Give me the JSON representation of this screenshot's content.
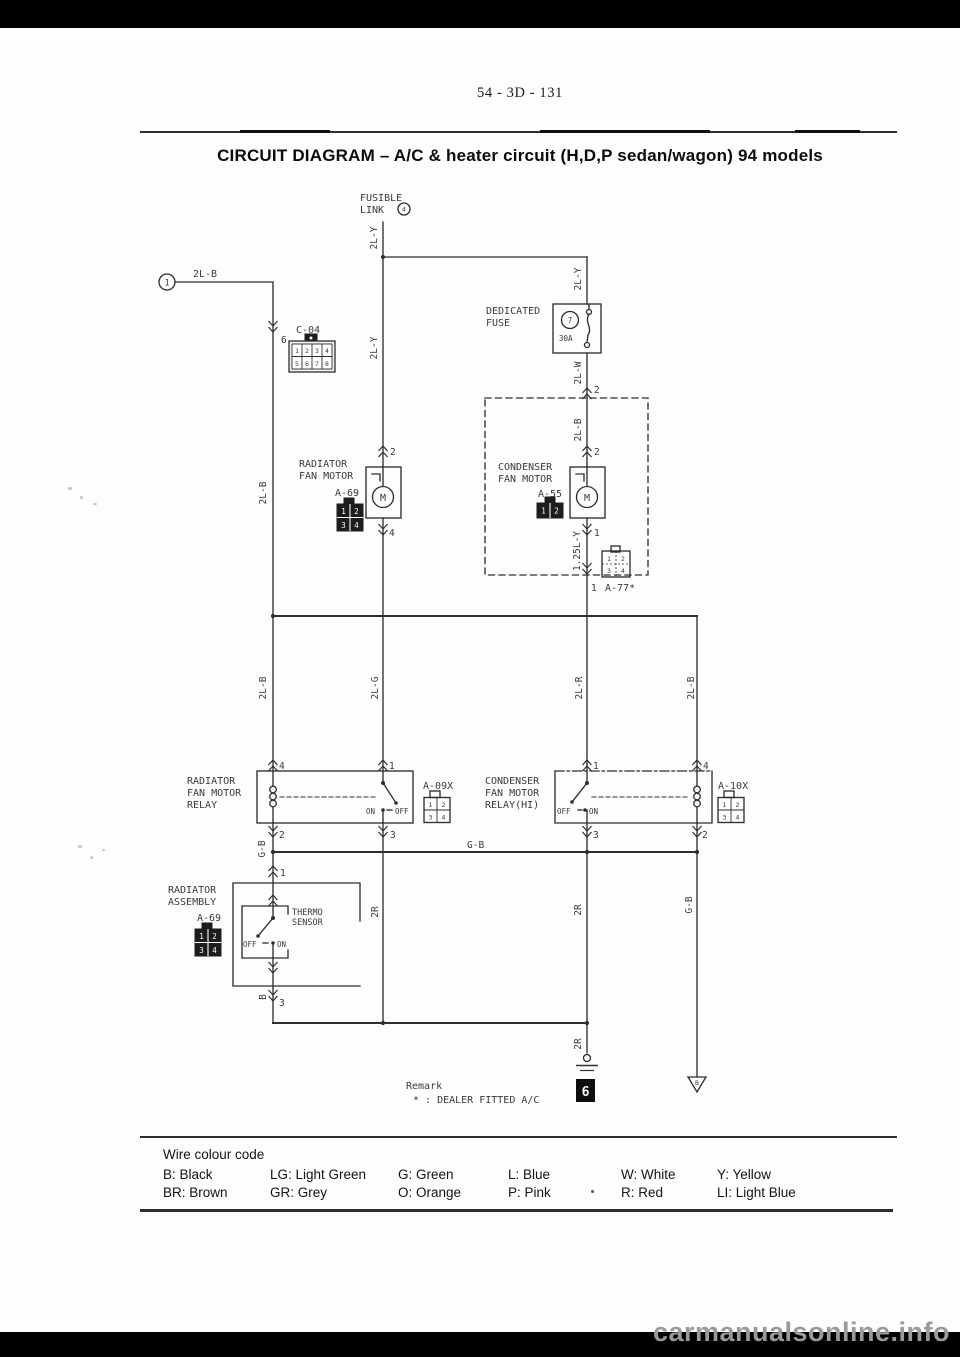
{
  "page": {
    "number": "54 - 3D - 131",
    "title": "CIRCUIT DIAGRAM – A/C & heater circuit (H,D,P sedan/wagon) 94 models"
  },
  "components": {
    "battery_circle": "1",
    "fusible_link": {
      "l1": "FUSIBLE",
      "l2": "LINK",
      "num": "4"
    },
    "dedicated_fuse": {
      "l1": "DEDICATED",
      "l2": "FUSE",
      "num": "7",
      "rating": "30A"
    },
    "c04": "C-04",
    "radiator_fan_motor": {
      "l1": "RADIATOR",
      "l2": "FAN MOTOR",
      "connector": "A-69"
    },
    "condenser_fan_motor": {
      "l1": "CONDENSER",
      "l2": "FAN MOTOR",
      "connector": "A-55"
    },
    "dealer_connector": "A-77*",
    "radiator_relay": {
      "l1": "RADIATOR",
      "l2": "FAN MOTOR",
      "l3": "RELAY",
      "connector": "A-09X"
    },
    "condenser_relay": {
      "l1": "CONDENSER",
      "l2": "FAN MOTOR",
      "l3": "RELAY(HI)",
      "connector": "A-10X"
    },
    "radiator_assembly": {
      "l1": "RADIATOR",
      "l2": "ASSEMBLY",
      "connector": "A-69"
    },
    "thermo_sensor": {
      "l1": "THERMO",
      "l2": "SENSOR"
    },
    "motor_letter": "M",
    "switch_on": "ON",
    "switch_off": "OFF",
    "ground_box": "6",
    "ground_b": "B"
  },
  "wires": {
    "w2lb": "2L-B",
    "w2ly": "2L-Y",
    "w2lw": "2L-W",
    "w2lg": "2L-G",
    "w2lr": "2L-R",
    "w125ly": "1.25L-Y",
    "wgb": "G-B",
    "w2r": "2R",
    "wb": "B"
  },
  "pins": {
    "p1": "1",
    "p2": "2",
    "p3": "3",
    "p4": "4",
    "p6": "6"
  },
  "cells": {
    "c1": "1",
    "c2": "2",
    "c3": "3",
    "c4": "4",
    "c5": "5",
    "c6": "6",
    "c7": "7",
    "c8": "8"
  },
  "remark": {
    "heading": "Remark",
    "text": "* : DEALER FITTED A/C"
  },
  "legend": {
    "heading": "Wire colour code",
    "row1": [
      "B: Black",
      "LG: Light Green",
      "G: Green",
      "L: Blue",
      "W: White",
      "Y: Yellow"
    ],
    "row2": [
      "BR: Brown",
      "GR: Grey",
      "O: Orange",
      "P: Pink",
      "R: Red",
      "LI: Light Blue"
    ]
  },
  "watermark": "carmanualsonline.info"
}
